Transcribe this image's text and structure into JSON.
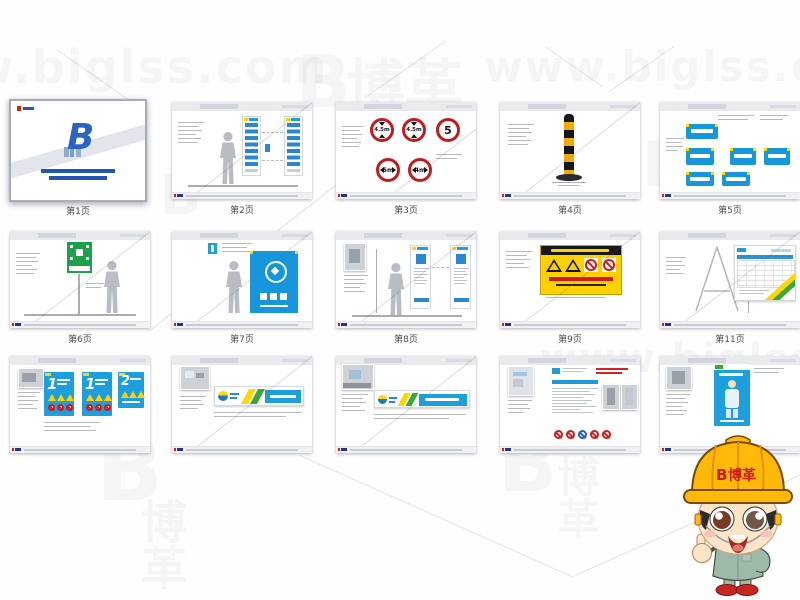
{
  "watermarks": {
    "url": "www.biglss.com",
    "brand": "博革",
    "brand_logo_letter": "B"
  },
  "captions": [
    "第1页",
    "第2页",
    "第3页",
    "第4页",
    "第5页",
    "第6页",
    "第7页",
    "第8页",
    "第9页",
    "第11页"
  ],
  "traffic_signs": {
    "height_limit_a": "4.5m",
    "height_limit_b": "4.5m",
    "speed_limit": "5",
    "width_limit_a": "5m",
    "width_limit_b": "4m"
  },
  "poster_numbers": [
    "1",
    "1",
    "2"
  ],
  "mascot": {
    "hat_logo_letter": "B",
    "hat_brand": "博革"
  }
}
